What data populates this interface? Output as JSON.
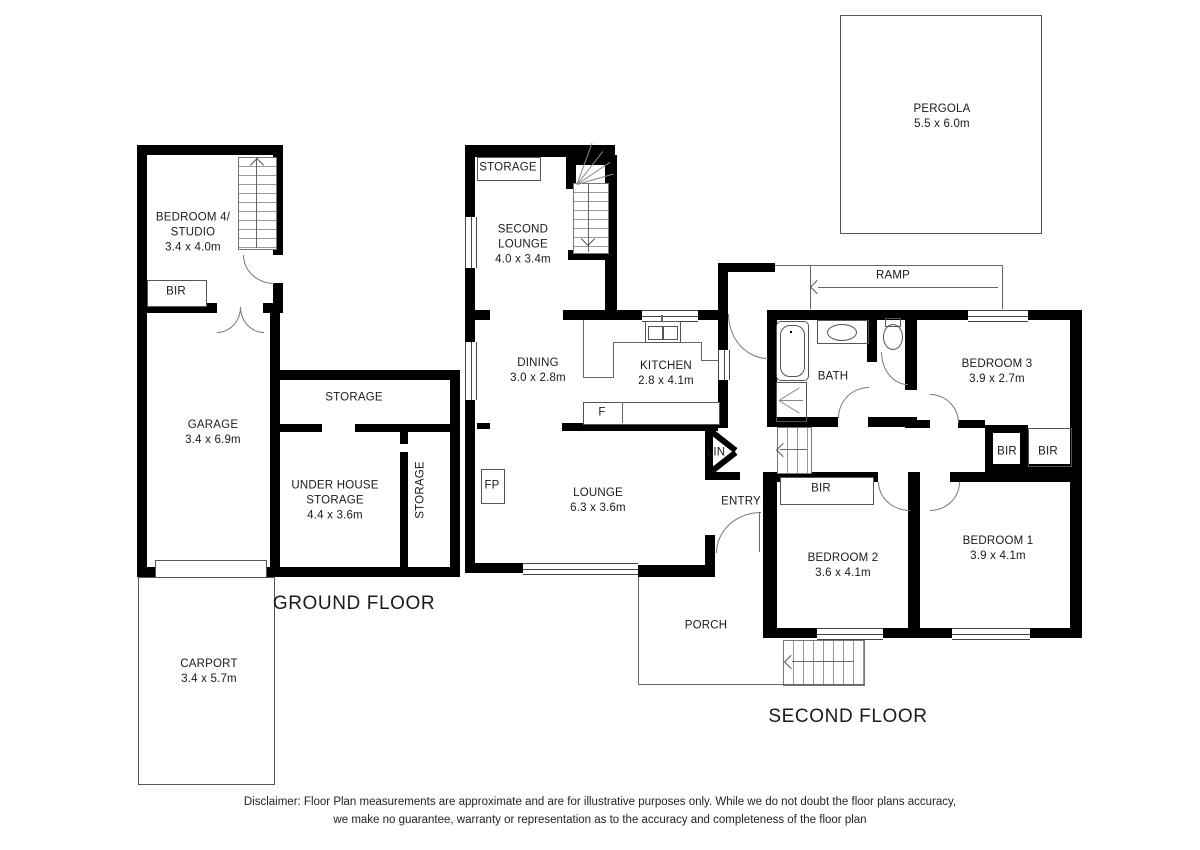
{
  "plan": {
    "floor_titles": {
      "ground": "GROUND FLOOR",
      "second": "SECOND FLOOR"
    }
  },
  "rooms": {
    "pergola": {
      "name": "PERGOLA",
      "dims": "5.5 x 6.0m"
    },
    "bedroom4": {
      "line1": "BEDROOM 4/",
      "line2": "STUDIO",
      "dims": "3.4 x 4.0m"
    },
    "bir_bedroom4": {
      "name": "BIR"
    },
    "garage": {
      "name": "GARAGE",
      "dims": "3.4 x 6.9m"
    },
    "storage_upper": {
      "name": "STORAGE"
    },
    "under_house_storage": {
      "line1": "UNDER HOUSE",
      "line2": "STORAGE",
      "dims": "4.4 x 3.6m"
    },
    "storage_side": {
      "name": "STORAGE"
    },
    "carport": {
      "name": "CARPORT",
      "dims": "3.4 x 5.7m"
    },
    "second_lounge": {
      "line1": "SECOND",
      "line2": "LOUNGE",
      "dims": "4.0 x 3.4m"
    },
    "storage_lounge": {
      "name": "STORAGE"
    },
    "dining": {
      "name": "DINING",
      "dims": "3.0 x 2.8m"
    },
    "kitchen": {
      "name": "KITCHEN",
      "dims": "2.8 x 4.1m"
    },
    "fridge": {
      "label": "F"
    },
    "fireplace": {
      "label": "FP"
    },
    "ramp": {
      "name": "RAMP"
    },
    "bath": {
      "name": "BATH"
    },
    "bedroom3": {
      "name": "BEDROOM 3",
      "dims": "3.9 x 2.7m"
    },
    "bir_left": {
      "name": "BIR"
    },
    "bir_right": {
      "name": "BIR"
    },
    "lounge": {
      "name": "LOUNGE",
      "dims": "6.3 x 3.6m"
    },
    "lin": {
      "name": "LIN"
    },
    "entry": {
      "name": "ENTRY"
    },
    "bir_bedroom2": {
      "name": "BIR"
    },
    "bedroom2": {
      "name": "BEDROOM 2",
      "dims": "3.6 x 4.1m"
    },
    "bedroom1": {
      "name": "BEDROOM 1",
      "dims": "3.9 x 4.1m"
    },
    "porch": {
      "name": "PORCH"
    }
  },
  "disclaimer": {
    "line1": "Disclaimer: Floor Plan measurements are approximate and are for illustrative purposes only. While we do not doubt the floor plans accuracy,",
    "line2": "we make no guarantee, warranty or representation as to the accuracy and completeness of the floor plan"
  },
  "colors": {
    "wall": "#000000",
    "thin_line": "#666666",
    "text": "#1a1a1a"
  }
}
